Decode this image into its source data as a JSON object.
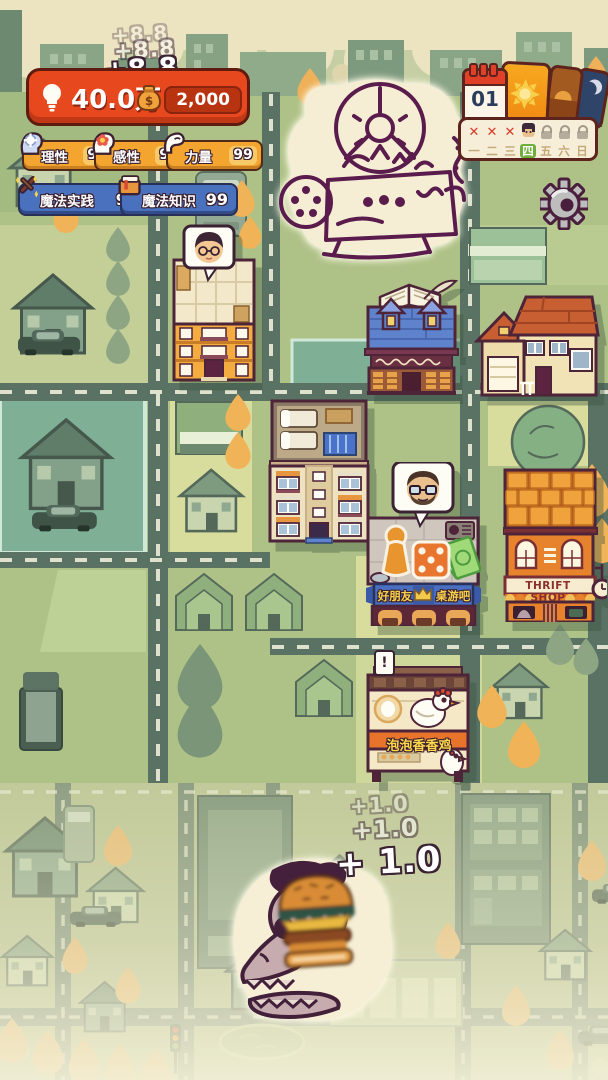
{
  "hud": {
    "gain_popups": {
      "t1": "+8.8",
      "t2": "+8.8",
      "t3": "+8.8"
    },
    "currency": {
      "knowledge": "40.0万",
      "money": "2,000",
      "money_symbol": "$"
    },
    "stats": [
      {
        "label": "理性",
        "value": "99"
      },
      {
        "label": "感性",
        "value": "99"
      },
      {
        "label": "力量",
        "value": "99"
      },
      {
        "label": "魔法实践",
        "value": "99"
      },
      {
        "label": "魔法知识",
        "value": "99"
      }
    ],
    "calendar": {
      "date": "01",
      "cross": "✕",
      "days": [
        "一",
        "二",
        "三",
        "四",
        "五",
        "六",
        "日"
      ],
      "active_day": "四"
    }
  },
  "shops": {
    "board_game_bar": {
      "sign_left": "好朋友",
      "sign_right": "桌游吧"
    },
    "thrift_shop": {
      "sign": "THRIFT SHOP"
    },
    "chicken_stall": {
      "sign": "泡泡香香鸡",
      "alert": "!"
    }
  },
  "rewards": {
    "t1": "+1.0",
    "t2": "+1.0",
    "t3": "+ 1.0"
  },
  "colors": {
    "hud_red": "#e8481e",
    "badge_orange": "#f3a52f",
    "badge_blue": "#4a71bd",
    "day_active_green": "#6fae3e",
    "road": "#5a7264",
    "doodle_ink": "#5a1c4c"
  }
}
